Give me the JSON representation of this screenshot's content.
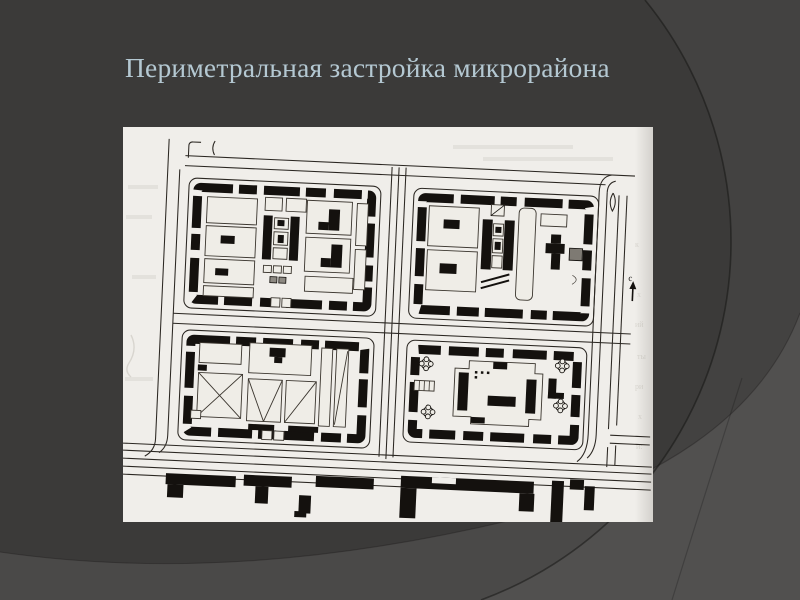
{
  "slide": {
    "title": "Периметральная застройка микрорайона",
    "colors": {
      "background_base": "#3b3a39",
      "background_corner_light": "#4f4e4d",
      "background_bottom_band": "#4a4948",
      "title_text": "#b4c8d2",
      "figure_page": "#f0eeea",
      "figure_ink": "#14110e"
    }
  },
  "map": {
    "north_label": "с"
  }
}
